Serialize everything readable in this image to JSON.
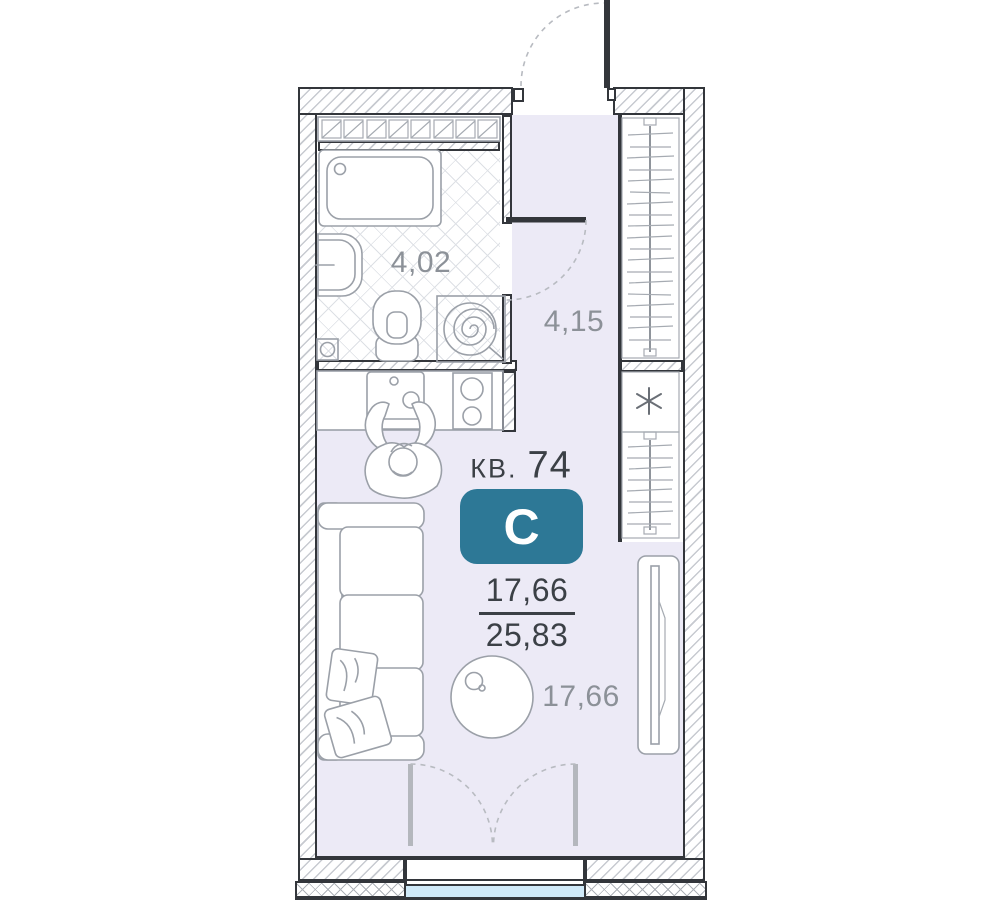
{
  "plan": {
    "apartment": {
      "prefix": "КВ.",
      "number": "74",
      "type_letter": "С"
    },
    "areas": {
      "bathroom": "4,02",
      "hallway": "4,15",
      "living": "17,66",
      "total_numerator": "17,66",
      "total_denominator": "25,83"
    },
    "colors": {
      "badge": "#2d7896",
      "floor": "#eceaf6",
      "window_glass": "#cfe9f8",
      "wall_line": "#33363b",
      "area_label": "#8c9198",
      "title_text": "#3b4046",
      "furniture_line": "#9ba0a8",
      "door_swing": "#b8bbc1"
    }
  }
}
